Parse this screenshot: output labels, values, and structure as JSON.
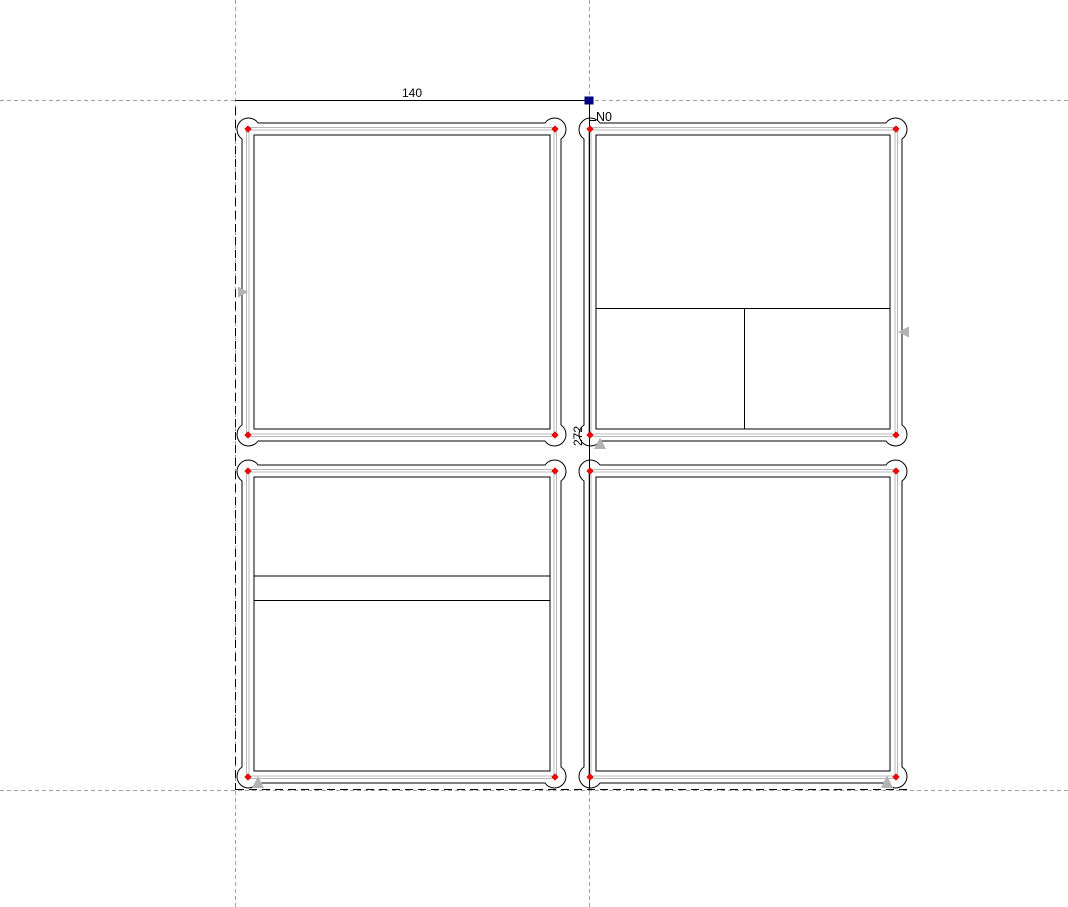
{
  "canvas": {
    "dimension_labels": {
      "width": "140",
      "height": "272"
    },
    "origin_marker": {
      "label": "N0",
      "icon": "origin-square-marker"
    },
    "colors": {
      "background": "#ffffff",
      "outline": "#000000",
      "guide": "#a2a2a2",
      "part_edge": "#b8b8b8",
      "arrow": "#b2b2b2",
      "handle": "#ff0000",
      "handle_edge": "#cc0000",
      "origin": "#00008b"
    },
    "panels": [
      {
        "id": "panel-top-left"
      },
      {
        "id": "panel-top-right"
      },
      {
        "id": "panel-bottom-left"
      },
      {
        "id": "panel-bottom-right"
      }
    ]
  }
}
